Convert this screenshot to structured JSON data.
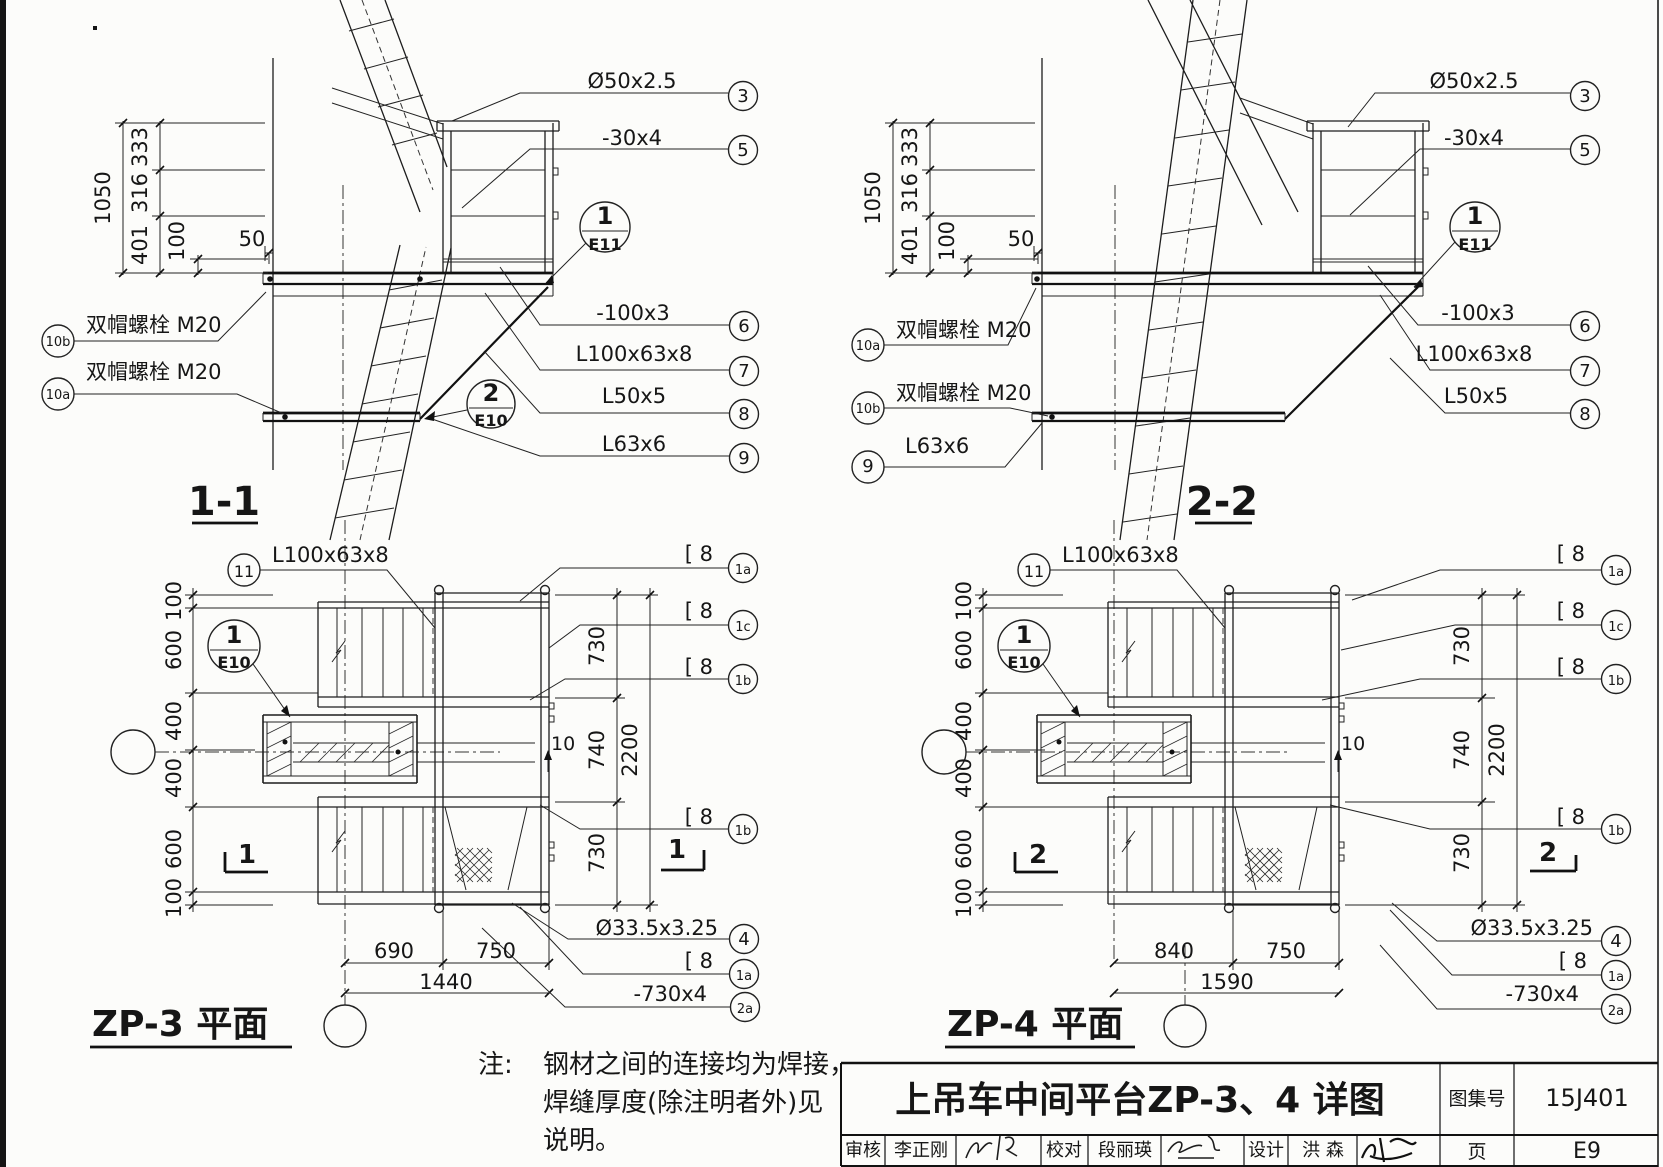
{
  "sheet": {
    "ink": "#1d1d1d",
    "paper": "#fcfcfa"
  },
  "views": {
    "section11": {
      "title": "1-1"
    },
    "section22": {
      "title": "2-2"
    },
    "plan_zp3": {
      "title": "ZP-3 平面"
    },
    "plan_zp4": {
      "title": "ZP-4 平面"
    }
  },
  "note": {
    "prefix": "注:",
    "line1": "钢材之间的连接均为焊接，",
    "line2": "焊缝厚度(除注明者外)见",
    "line3": "说明。"
  },
  "title_block": {
    "main_title": "上吊车中间平台ZP-3、4 详图",
    "atlas_label": "图集号",
    "atlas_no": "15J401",
    "page_label": "页",
    "page_no": "E9",
    "reviewer_label": "审核",
    "reviewer_name": "李正刚",
    "checker_label": "校对",
    "checker_name": "段丽瑛",
    "designer_label": "设计",
    "designer_name": "洪  森"
  },
  "annotations": [
    {
      "n": "s11-label-pipe50",
      "t": "Ø50x2.5",
      "x": 632,
      "y": 88,
      "a": "m"
    },
    {
      "n": "s11-num-3",
      "t": "3",
      "x": 743,
      "y": 102,
      "a": "m",
      "s": 18
    },
    {
      "n": "s11-label-flat30x4",
      "t": "-30x4",
      "x": 632,
      "y": 145,
      "a": "m"
    },
    {
      "n": "s11-num-5",
      "t": "5",
      "x": 743,
      "y": 156,
      "a": "m",
      "s": 18
    },
    {
      "n": "s11-label-flat100x3",
      "t": "-100x3",
      "x": 633,
      "y": 320,
      "a": "m"
    },
    {
      "n": "s11-num-6",
      "t": "6",
      "x": 744,
      "y": 332,
      "a": "m",
      "s": 18
    },
    {
      "n": "s11-label-L100x63x8",
      "t": "L100x63x8",
      "x": 634,
      "y": 361,
      "a": "m"
    },
    {
      "n": "s11-num-7",
      "t": "7",
      "x": 744,
      "y": 377,
      "a": "m",
      "s": 18
    },
    {
      "n": "s11-label-L50x5",
      "t": "L50x5",
      "x": 634,
      "y": 403,
      "a": "m"
    },
    {
      "n": "s11-num-8",
      "t": "8",
      "x": 744,
      "y": 420,
      "a": "m",
      "s": 18
    },
    {
      "n": "s11-label-L63x6",
      "t": "L63x6",
      "x": 634,
      "y": 451,
      "a": "m"
    },
    {
      "n": "s11-num-9",
      "t": "9",
      "x": 744,
      "y": 464,
      "a": "m",
      "s": 18
    },
    {
      "n": "s11-detail-e11-num",
      "t": "1",
      "x": 605,
      "y": 224,
      "a": "m",
      "s": 24,
      "b": 1
    },
    {
      "n": "s11-detail-e11-ref",
      "t": "E11",
      "x": 605,
      "y": 250,
      "a": "m",
      "s": 16,
      "b": 1
    },
    {
      "n": "s11-detail-e10-num",
      "t": "2",
      "x": 491,
      "y": 401,
      "a": "m",
      "s": 24,
      "b": 1
    },
    {
      "n": "s11-detail-e10-ref",
      "t": "E10",
      "x": 491,
      "y": 426,
      "a": "m",
      "s": 16,
      "b": 1
    },
    {
      "n": "s11-dim-1050",
      "t": "1050",
      "x": 110,
      "y": 198,
      "a": "m",
      "r": 1
    },
    {
      "n": "s11-dim-333",
      "t": "333",
      "x": 147,
      "y": 147,
      "a": "m",
      "r": 1
    },
    {
      "n": "s11-dim-316",
      "t": "316",
      "x": 147,
      "y": 193,
      "a": "m",
      "r": 1
    },
    {
      "n": "s11-dim-401",
      "t": "401",
      "x": 147,
      "y": 245,
      "a": "m",
      "r": 1
    },
    {
      "n": "s11-dim-100",
      "t": "100",
      "x": 184,
      "y": 241,
      "a": "m",
      "r": 1
    },
    {
      "n": "s11-dim-50",
      "t": "50",
      "x": 252,
      "y": 246,
      "a": "m"
    },
    {
      "n": "s11-label-bolt-10b",
      "t": "双帽螺栓 M20",
      "x": 86,
      "y": 332
    },
    {
      "n": "s11-num-10b",
      "t": "10b",
      "x": 58,
      "y": 346,
      "a": "m",
      "s": 13
    },
    {
      "n": "s11-label-bolt-10a",
      "t": "双帽螺栓 M20",
      "x": 86,
      "y": 379
    },
    {
      "n": "s11-num-10a",
      "t": "10a",
      "x": 58,
      "y": 399,
      "a": "m",
      "s": 13
    },
    {
      "n": "s22-label-pipe50",
      "t": "Ø50x2.5",
      "x": 1474,
      "y": 88,
      "a": "m"
    },
    {
      "n": "s22-num-3",
      "t": "3",
      "x": 1585,
      "y": 102,
      "a": "m",
      "s": 18
    },
    {
      "n": "s22-label-flat30x4",
      "t": "-30x4",
      "x": 1474,
      "y": 145,
      "a": "m"
    },
    {
      "n": "s22-num-5",
      "t": "5",
      "x": 1585,
      "y": 156,
      "a": "m",
      "s": 18
    },
    {
      "n": "s22-label-flat100x3",
      "t": "-100x3",
      "x": 1478,
      "y": 320,
      "a": "m"
    },
    {
      "n": "s22-num-6",
      "t": "6",
      "x": 1585,
      "y": 332,
      "a": "m",
      "s": 18
    },
    {
      "n": "s22-label-L100x63x8",
      "t": "L100x63x8",
      "x": 1474,
      "y": 361,
      "a": "m"
    },
    {
      "n": "s22-num-7",
      "t": "7",
      "x": 1585,
      "y": 377,
      "a": "m",
      "s": 18
    },
    {
      "n": "s22-label-L50x5",
      "t": "L50x5",
      "x": 1476,
      "y": 403,
      "a": "m"
    },
    {
      "n": "s22-num-8",
      "t": "8",
      "x": 1585,
      "y": 420,
      "a": "m",
      "s": 18
    },
    {
      "n": "s22-detail-e11-num",
      "t": "1",
      "x": 1475,
      "y": 224,
      "a": "m",
      "s": 24,
      "b": 1
    },
    {
      "n": "s22-detail-e11-ref",
      "t": "E11",
      "x": 1475,
      "y": 250,
      "a": "m",
      "s": 16,
      "b": 1
    },
    {
      "n": "s22-dim-1050",
      "t": "1050",
      "x": 880,
      "y": 198,
      "a": "m",
      "r": 1
    },
    {
      "n": "s22-dim-333",
      "t": "333",
      "x": 917,
      "y": 147,
      "a": "m",
      "r": 1
    },
    {
      "n": "s22-dim-316",
      "t": "316",
      "x": 917,
      "y": 193,
      "a": "m",
      "r": 1
    },
    {
      "n": "s22-dim-401",
      "t": "401",
      "x": 917,
      "y": 245,
      "a": "m",
      "r": 1
    },
    {
      "n": "s22-dim-100",
      "t": "100",
      "x": 954,
      "y": 241,
      "a": "m",
      "r": 1
    },
    {
      "n": "s22-dim-50",
      "t": "50",
      "x": 1021,
      "y": 246,
      "a": "m"
    },
    {
      "n": "s22-label-bolt-10a",
      "t": "双帽螺栓 M20",
      "x": 896,
      "y": 337
    },
    {
      "n": "s22-num-10a",
      "t": "10a",
      "x": 868,
      "y": 350,
      "a": "m",
      "s": 13
    },
    {
      "n": "s22-label-bolt-10b",
      "t": "双帽螺栓 M20",
      "x": 896,
      "y": 400
    },
    {
      "n": "s22-num-10b",
      "t": "10b",
      "x": 868,
      "y": 413,
      "a": "m",
      "s": 13
    },
    {
      "n": "s22-label-L63x6",
      "t": "L63x6",
      "x": 905,
      "y": 453
    },
    {
      "n": "s22-num-9",
      "t": "9",
      "x": 868,
      "y": 472,
      "a": "m",
      "s": 18
    },
    {
      "n": "zp3-label-L100x63x8",
      "t": "L100x63x8",
      "x": 272,
      "y": 562
    },
    {
      "n": "zp3-num-11",
      "t": "11",
      "x": 244,
      "y": 577,
      "a": "m",
      "s": 16
    },
    {
      "n": "zp3-detail-e10-num",
      "t": "1",
      "x": 234,
      "y": 643,
      "a": "m",
      "s": 24,
      "b": 1
    },
    {
      "n": "zp3-detail-e10-ref",
      "t": "E10",
      "x": 234,
      "y": 668,
      "a": "m",
      "s": 16,
      "b": 1
    },
    {
      "n": "zp3-dim-100t",
      "t": "100",
      "x": 181,
      "y": 601,
      "a": "m",
      "r": 1
    },
    {
      "n": "zp3-dim-600t",
      "t": "600",
      "x": 181,
      "y": 650,
      "a": "m",
      "r": 1
    },
    {
      "n": "zp3-dim-400t",
      "t": "400",
      "x": 181,
      "y": 721,
      "a": "m",
      "r": 1
    },
    {
      "n": "zp3-dim-400b",
      "t": "400",
      "x": 181,
      "y": 778,
      "a": "m",
      "r": 1
    },
    {
      "n": "zp3-dim-600b",
      "t": "600",
      "x": 181,
      "y": 849,
      "a": "m",
      "r": 1
    },
    {
      "n": "zp3-dim-100b",
      "t": "100",
      "x": 181,
      "y": 898,
      "a": "m",
      "r": 1
    },
    {
      "n": "zp3-dim-730t",
      "t": "730",
      "x": 604,
      "y": 646,
      "a": "m",
      "r": 1
    },
    {
      "n": "zp3-dim-740",
      "t": "740",
      "x": 604,
      "y": 750,
      "a": "m",
      "r": 1
    },
    {
      "n": "zp3-dim-730b",
      "t": "730",
      "x": 604,
      "y": 853,
      "a": "m",
      "r": 1
    },
    {
      "n": "zp3-dim-2200",
      "t": "2200",
      "x": 637,
      "y": 750,
      "a": "m",
      "r": 1
    },
    {
      "n": "zp3-dim-690",
      "t": "690",
      "x": 394,
      "y": 958,
      "a": "m"
    },
    {
      "n": "zp3-dim-750",
      "t": "750",
      "x": 496,
      "y": 958,
      "a": "m"
    },
    {
      "n": "zp3-dim-1440",
      "t": "1440",
      "x": 446,
      "y": 989,
      "a": "m"
    },
    {
      "n": "zp3-label-c8-1a",
      "t": "[ 8",
      "x": 713,
      "y": 561,
      "a": "e"
    },
    {
      "n": "zp3-num-1a",
      "t": "1a",
      "x": 743,
      "y": 574,
      "a": "m",
      "s": 13
    },
    {
      "n": "zp3-label-c8-1c",
      "t": "[ 8",
      "x": 713,
      "y": 618,
      "a": "e"
    },
    {
      "n": "zp3-num-1c",
      "t": "1c",
      "x": 743,
      "y": 631,
      "a": "m",
      "s": 13
    },
    {
      "n": "zp3-label-c8-1b1",
      "t": "[ 8",
      "x": 713,
      "y": 674,
      "a": "e"
    },
    {
      "n": "zp3-num-1b1",
      "t": "1b",
      "x": 743,
      "y": 685,
      "a": "m",
      "s": 13
    },
    {
      "n": "zp3-label-c8-1b2",
      "t": "[ 8",
      "x": 713,
      "y": 824,
      "a": "e"
    },
    {
      "n": "zp3-num-1b2",
      "t": "1b",
      "x": 743,
      "y": 835,
      "a": "m",
      "s": 13
    },
    {
      "n": "zp3-label-pipe33",
      "t": "Ø33.5x3.25",
      "x": 718,
      "y": 935,
      "a": "e"
    },
    {
      "n": "zp3-num-4",
      "t": "4",
      "x": 744,
      "y": 945,
      "a": "m",
      "s": 18
    },
    {
      "n": "zp3-label-c8-1a2",
      "t": "[ 8",
      "x": 713,
      "y": 968,
      "a": "e"
    },
    {
      "n": "zp3-num-1a2",
      "t": "1a",
      "x": 744,
      "y": 980,
      "a": "m",
      "s": 13
    },
    {
      "n": "zp3-label-730x4",
      "t": "-730x4",
      "x": 707,
      "y": 1001,
      "a": "e"
    },
    {
      "n": "zp3-num-2a",
      "t": "2a",
      "x": 745,
      "y": 1013,
      "a": "m",
      "s": 13
    },
    {
      "n": "zp3-weld-10",
      "t": "10",
      "x": 551,
      "y": 750,
      "s": 19
    },
    {
      "n": "zp3-cut-1-left",
      "t": "1",
      "x": 247,
      "y": 863,
      "a": "m",
      "s": 26,
      "b": 1
    },
    {
      "n": "zp3-cut-1-right",
      "t": "1",
      "x": 677,
      "y": 858,
      "a": "m",
      "s": 26,
      "b": 1
    },
    {
      "n": "zp4-label-L100x63x8",
      "t": "L100x63x8",
      "x": 1062,
      "y": 562
    },
    {
      "n": "zp4-num-11",
      "t": "11",
      "x": 1034,
      "y": 577,
      "a": "m",
      "s": 16
    },
    {
      "n": "zp4-detail-e10-num",
      "t": "1",
      "x": 1024,
      "y": 643,
      "a": "m",
      "s": 24,
      "b": 1
    },
    {
      "n": "zp4-detail-e10-ref",
      "t": "E10",
      "x": 1024,
      "y": 668,
      "a": "m",
      "s": 16,
      "b": 1
    },
    {
      "n": "zp4-dim-100t",
      "t": "100",
      "x": 971,
      "y": 601,
      "a": "m",
      "r": 1
    },
    {
      "n": "zp4-dim-600t",
      "t": "600",
      "x": 971,
      "y": 650,
      "a": "m",
      "r": 1
    },
    {
      "n": "zp4-dim-400t",
      "t": "400",
      "x": 971,
      "y": 721,
      "a": "m",
      "r": 1
    },
    {
      "n": "zp4-dim-400b",
      "t": "400",
      "x": 971,
      "y": 778,
      "a": "m",
      "r": 1
    },
    {
      "n": "zp4-dim-600b",
      "t": "600",
      "x": 971,
      "y": 849,
      "a": "m",
      "r": 1
    },
    {
      "n": "zp4-dim-100b",
      "t": "100",
      "x": 971,
      "y": 898,
      "a": "m",
      "r": 1
    },
    {
      "n": "zp4-dim-730t",
      "t": "730",
      "x": 1469,
      "y": 646,
      "a": "m",
      "r": 1
    },
    {
      "n": "zp4-dim-740",
      "t": "740",
      "x": 1469,
      "y": 750,
      "a": "m",
      "r": 1
    },
    {
      "n": "zp4-dim-730b",
      "t": "730",
      "x": 1469,
      "y": 853,
      "a": "m",
      "r": 1
    },
    {
      "n": "zp4-dim-2200",
      "t": "2200",
      "x": 1504,
      "y": 750,
      "a": "m",
      "r": 1
    },
    {
      "n": "zp4-dim-840",
      "t": "840",
      "x": 1174,
      "y": 958,
      "a": "m"
    },
    {
      "n": "zp4-dim-750",
      "t": "750",
      "x": 1286,
      "y": 958,
      "a": "m"
    },
    {
      "n": "zp4-dim-1590",
      "t": "1590",
      "x": 1227,
      "y": 989,
      "a": "m"
    },
    {
      "n": "zp4-label-c8-1a",
      "t": "[ 8",
      "x": 1585,
      "y": 561,
      "a": "e"
    },
    {
      "n": "zp4-num-1a",
      "t": "1a",
      "x": 1616,
      "y": 576,
      "a": "m",
      "s": 13
    },
    {
      "n": "zp4-label-c8-1c",
      "t": "[ 8",
      "x": 1585,
      "y": 618,
      "a": "e"
    },
    {
      "n": "zp4-num-1c",
      "t": "1c",
      "x": 1616,
      "y": 631,
      "a": "m",
      "s": 13
    },
    {
      "n": "zp4-label-c8-1b1",
      "t": "[ 8",
      "x": 1585,
      "y": 674,
      "a": "e"
    },
    {
      "n": "zp4-num-1b1",
      "t": "1b",
      "x": 1616,
      "y": 685,
      "a": "m",
      "s": 13
    },
    {
      "n": "zp4-label-c8-1b2",
      "t": "[ 8",
      "x": 1585,
      "y": 824,
      "a": "e"
    },
    {
      "n": "zp4-num-1b2",
      "t": "1b",
      "x": 1616,
      "y": 835,
      "a": "m",
      "s": 13
    },
    {
      "n": "zp4-label-pipe33",
      "t": "Ø33.5x3.25",
      "x": 1593,
      "y": 935,
      "a": "e"
    },
    {
      "n": "zp4-num-4",
      "t": "4",
      "x": 1616,
      "y": 947,
      "a": "m",
      "s": 18
    },
    {
      "n": "zp4-label-c8-1a2",
      "t": "[ 8",
      "x": 1587,
      "y": 968,
      "a": "e"
    },
    {
      "n": "zp4-num-1a2",
      "t": "1a",
      "x": 1616,
      "y": 981,
      "a": "m",
      "s": 13
    },
    {
      "n": "zp4-label-730x4",
      "t": "-730x4",
      "x": 1579,
      "y": 1001,
      "a": "e"
    },
    {
      "n": "zp4-num-2a",
      "t": "2a",
      "x": 1616,
      "y": 1015,
      "a": "m",
      "s": 13
    },
    {
      "n": "zp4-weld-10",
      "t": "10",
      "x": 1341,
      "y": 750,
      "s": 19
    },
    {
      "n": "zp4-cut-2-left",
      "t": "2",
      "x": 1038,
      "y": 863,
      "a": "m",
      "s": 26,
      "b": 1
    },
    {
      "n": "zp4-cut-2-right",
      "t": "2",
      "x": 1548,
      "y": 861,
      "a": "m",
      "s": 26,
      "b": 1
    }
  ]
}
